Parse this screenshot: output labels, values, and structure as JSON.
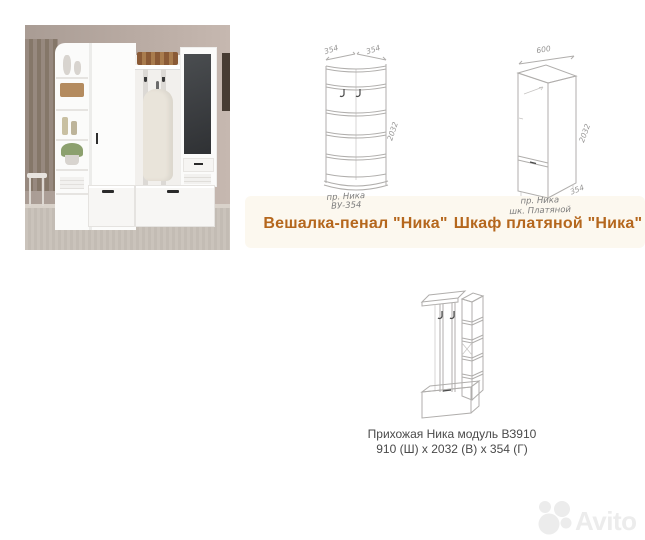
{
  "colors": {
    "caption_accent": "#b5671d",
    "module_caption_text": "#4a4a4a",
    "drawing_line": "#b0aeac",
    "watermark_gray": "#ececec",
    "photo_wall": "#b3a69e",
    "photo_curtain": "#8f8178",
    "photo_floor": "#c8c1b9",
    "photo_mirror": "#3d4043",
    "furniture_white": "#fbfbfa"
  },
  "drawings": {
    "penal": {
      "caption": "Вешалка-пенал \"Ника\"",
      "dims": {
        "width_left": "354",
        "width_right": "354",
        "height": "2032"
      },
      "label": {
        "line1": "пр. Ника",
        "line2": "ВУ-354"
      }
    },
    "wardrobe": {
      "caption": "Шкаф платяной \"Ника\"",
      "dims": {
        "width": "600",
        "height": "2032",
        "depth": "354"
      },
      "label": {
        "line1": "пр. Ника",
        "line2": "шк. Платяной"
      }
    },
    "module": {
      "caption_line1": "Прихожая Ника модуль ВЗ910",
      "caption_line2": "910 (Ш) x 2032 (В) x 354 (Г)"
    }
  },
  "watermark": {
    "brand": "Avito"
  }
}
